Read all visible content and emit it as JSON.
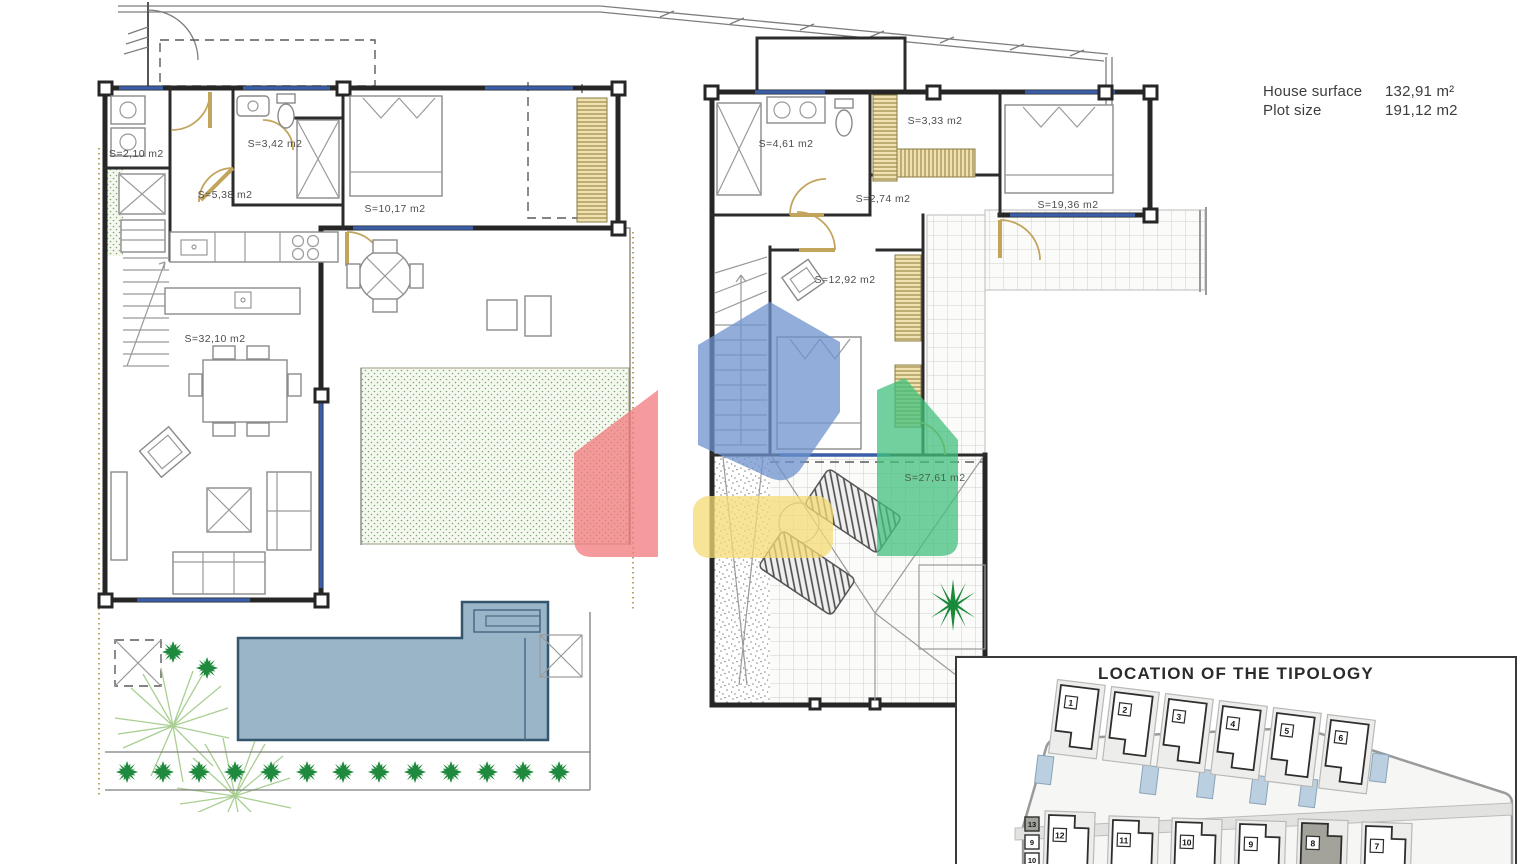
{
  "palette": {
    "pool": "#9ab4c8",
    "highlight_house": "#a3a39b",
    "watermark_red": "#f2797e",
    "watermark_blue": "#6d92cc",
    "watermark_yellow": "#f4db73",
    "watermark_green": "#41c07c"
  },
  "title_block": {
    "house_surface_label": "House surface",
    "house_surface_value": "132,91 m²",
    "plot_size_label": "Plot size",
    "plot_size_value": "191,12 m2"
  },
  "ground_floor_plan": {
    "utility_label": "S=2,10 m2",
    "bathroom_label": "S=3,42 m2",
    "hallway_label": "S=5,38 m2",
    "bedroom_label": "S=10,17 m2",
    "living_kitchen_label": "S=32,10 m2"
  },
  "first_floor_plan": {
    "bathroom_label": "S=4,61 m2",
    "dressing_label": "S=3,33 m2",
    "landing_label": "S=2,74 m2",
    "master_bedroom_label": "S=19,36 m2",
    "bedroom2_label": "S=12,92 m2",
    "terrace_label": "S=27,61 m2"
  },
  "site_plan": {
    "title": "LOCATION OF THE TIPOLOGY",
    "top_row_houses": [
      "1",
      "2",
      "3",
      "4",
      "5",
      "6"
    ],
    "bottom_row_houses": [
      "12",
      "11",
      "10",
      "9",
      "8",
      "7"
    ],
    "side_units": [
      "13",
      "9",
      "10"
    ],
    "highlighted_house": "8"
  }
}
